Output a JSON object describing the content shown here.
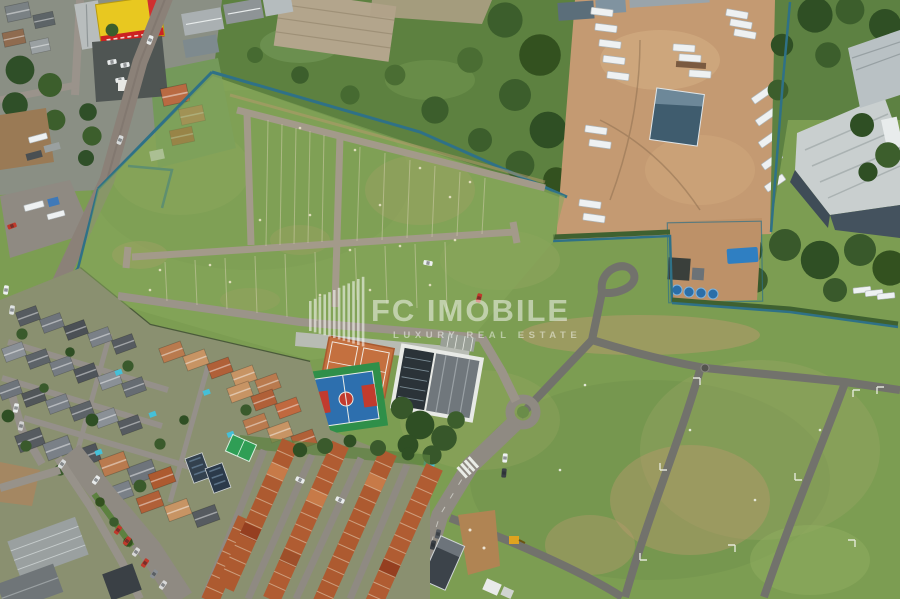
{
  "image": {
    "type": "aerial-drone-photograph",
    "width": 900,
    "height": 599,
    "description": "Aerial view of a gated residential land subdivision (vacant lots with new gravel roads, perimeter fence, clubhouse with tennis and basketball courts, roundabout and entrance boulevard), bordered by an industrial truck yard with warehouses at top right, scrubland at top, and dense residential neighborhoods with terracotta and gray roofs at bottom left"
  },
  "watermark": {
    "brand": "FC IMOBILE",
    "tagline": "LUXURY REAL ESTATE",
    "logo": "striped-building-bars-logo",
    "color": "#ffffff",
    "opacity": 0.55
  },
  "scene": {
    "regions": [
      "top-left commercial block with yellow retail building and parking",
      "diagonal avenue with perimeter fence",
      "north scrubland with trees and old gravel pad",
      "industrial truck yard with white semi-trailers",
      "blue warehouse and large gray logistics warehouse",
      "eastern tree belt",
      "western subdivision field with gravel lot roads and survey stakes",
      "utility compound with blue water tanks and container",
      "eastern subdivision field with asphalt roads and lot corner marks",
      "roundabout and entrance boulevard with crosswalk",
      "clubhouse, clay tennis courts, blue sports court, pool and trees",
      "southwest residential neighborhood with pools and parked cars",
      "orange-roof rowhouse block",
      "centered real-estate watermark"
    ]
  },
  "palette": {
    "grass": "#7c9d52",
    "scrub": "#5d8140",
    "tree_dark": "#33511f",
    "dirt": "#c49a72",
    "road_gravel": "#98928a",
    "road_asphalt": "#72726c",
    "fence_teal": "#2f7187",
    "roof_orange": "#ad5a30",
    "roof_gray": "#565b60",
    "court_blue": "#2d6fae",
    "court_red": "#c23b2e",
    "clay_orange": "#c4703f",
    "pool_aqua": "#45c0d8",
    "warehouse_roof": "#c9cfcf",
    "store_yellow": "#e8c820",
    "watermark_white": "#ffffff"
  }
}
